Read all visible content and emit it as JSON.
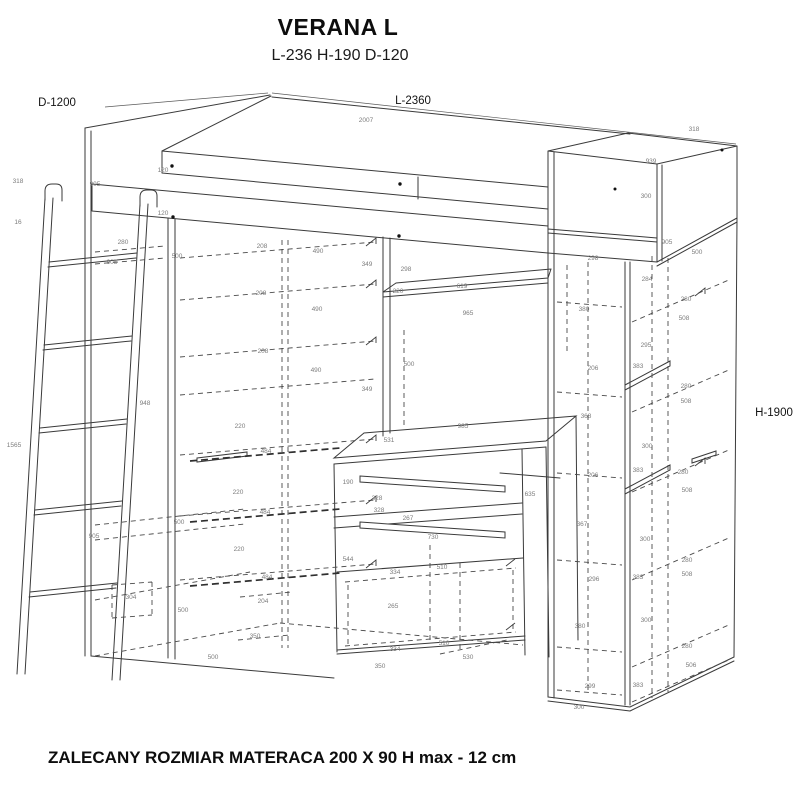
{
  "title": "VERANA L",
  "subtitle": "L-236 H-190 D-120",
  "footer": "ZALECANY ROZMIAR MATERACA 200 X 90 H max - 12 cm",
  "style_colors": {
    "line": "#3a3a3a",
    "dim_label": "#7d7d7d"
  },
  "main_dimensions": [
    {
      "text": "D-1200",
      "x": 57,
      "y": 106
    },
    {
      "text": "L-2360",
      "x": 413,
      "y": 104
    },
    {
      "text": "H-1900",
      "x": 774,
      "y": 416
    }
  ],
  "dimension_labels": [
    {
      "t": "2007",
      "x": 366,
      "y": 122
    },
    {
      "t": "318",
      "x": 694,
      "y": 131
    },
    {
      "t": "939",
      "x": 651,
      "y": 163
    },
    {
      "t": "300",
      "x": 646,
      "y": 198
    },
    {
      "t": "120",
      "x": 163,
      "y": 172
    },
    {
      "t": "120",
      "x": 163,
      "y": 215
    },
    {
      "t": "905",
      "x": 95,
      "y": 186
    },
    {
      "t": "318",
      "x": 18,
      "y": 183
    },
    {
      "t": "16",
      "x": 18,
      "y": 224
    },
    {
      "t": "905",
      "x": 667,
      "y": 244
    },
    {
      "t": "500",
      "x": 697,
      "y": 254
    },
    {
      "t": "298",
      "x": 593,
      "y": 260
    },
    {
      "t": "284",
      "x": 647,
      "y": 281
    },
    {
      "t": "380",
      "x": 584,
      "y": 311
    },
    {
      "t": "280",
      "x": 686,
      "y": 301
    },
    {
      "t": "508",
      "x": 684,
      "y": 320
    },
    {
      "t": "295",
      "x": 646,
      "y": 347
    },
    {
      "t": "280",
      "x": 123,
      "y": 244
    },
    {
      "t": "905",
      "x": 112,
      "y": 264
    },
    {
      "t": "500",
      "x": 177,
      "y": 258
    },
    {
      "t": "208",
      "x": 262,
      "y": 248
    },
    {
      "t": "490",
      "x": 318,
      "y": 253
    },
    {
      "t": "208",
      "x": 261,
      "y": 295
    },
    {
      "t": "490",
      "x": 317,
      "y": 311
    },
    {
      "t": "208",
      "x": 263,
      "y": 353
    },
    {
      "t": "490",
      "x": 316,
      "y": 372
    },
    {
      "t": "349",
      "x": 367,
      "y": 266
    },
    {
      "t": "298",
      "x": 406,
      "y": 271
    },
    {
      "t": "619",
      "x": 462,
      "y": 288
    },
    {
      "t": "220",
      "x": 398,
      "y": 293
    },
    {
      "t": "965",
      "x": 468,
      "y": 315
    },
    {
      "t": "500",
      "x": 409,
      "y": 366
    },
    {
      "t": "349",
      "x": 367,
      "y": 391
    },
    {
      "t": "948",
      "x": 145,
      "y": 405
    },
    {
      "t": "1565",
      "x": 14,
      "y": 447
    },
    {
      "t": "220",
      "x": 240,
      "y": 428
    },
    {
      "t": "484",
      "x": 266,
      "y": 453
    },
    {
      "t": "220",
      "x": 238,
      "y": 494
    },
    {
      "t": "484",
      "x": 265,
      "y": 514
    },
    {
      "t": "220",
      "x": 239,
      "y": 551
    },
    {
      "t": "484",
      "x": 267,
      "y": 579
    },
    {
      "t": "905",
      "x": 94,
      "y": 538
    },
    {
      "t": "500",
      "x": 179,
      "y": 524
    },
    {
      "t": "304",
      "x": 131,
      "y": 599
    },
    {
      "t": "500",
      "x": 183,
      "y": 612
    },
    {
      "t": "204",
      "x": 263,
      "y": 603
    },
    {
      "t": "350",
      "x": 255,
      "y": 638
    },
    {
      "t": "500",
      "x": 213,
      "y": 659
    },
    {
      "t": "985",
      "x": 463,
      "y": 428
    },
    {
      "t": "531",
      "x": 389,
      "y": 442
    },
    {
      "t": "190",
      "x": 348,
      "y": 484
    },
    {
      "t": "328",
      "x": 377,
      "y": 500
    },
    {
      "t": "328",
      "x": 379,
      "y": 512
    },
    {
      "t": "267",
      "x": 408,
      "y": 520
    },
    {
      "t": "730",
      "x": 433,
      "y": 539
    },
    {
      "t": "635",
      "x": 530,
      "y": 496
    },
    {
      "t": "544",
      "x": 348,
      "y": 561
    },
    {
      "t": "334",
      "x": 395,
      "y": 574
    },
    {
      "t": "510",
      "x": 442,
      "y": 569
    },
    {
      "t": "265",
      "x": 393,
      "y": 608
    },
    {
      "t": "334",
      "x": 395,
      "y": 651
    },
    {
      "t": "510",
      "x": 444,
      "y": 645
    },
    {
      "t": "530",
      "x": 468,
      "y": 659
    },
    {
      "t": "350",
      "x": 380,
      "y": 668
    },
    {
      "t": "206",
      "x": 593,
      "y": 370
    },
    {
      "t": "383",
      "x": 638,
      "y": 368
    },
    {
      "t": "280",
      "x": 686,
      "y": 388
    },
    {
      "t": "508",
      "x": 686,
      "y": 403
    },
    {
      "t": "368",
      "x": 586,
      "y": 418
    },
    {
      "t": "300",
      "x": 647,
      "y": 448
    },
    {
      "t": "206",
      "x": 593,
      "y": 477
    },
    {
      "t": "383",
      "x": 638,
      "y": 472
    },
    {
      "t": "280",
      "x": 683,
      "y": 474
    },
    {
      "t": "508",
      "x": 687,
      "y": 492
    },
    {
      "t": "367",
      "x": 582,
      "y": 526
    },
    {
      "t": "300",
      "x": 645,
      "y": 541
    },
    {
      "t": "296",
      "x": 594,
      "y": 581
    },
    {
      "t": "383",
      "x": 638,
      "y": 579
    },
    {
      "t": "280",
      "x": 687,
      "y": 562
    },
    {
      "t": "508",
      "x": 687,
      "y": 576
    },
    {
      "t": "380",
      "x": 580,
      "y": 628
    },
    {
      "t": "300",
      "x": 646,
      "y": 622
    },
    {
      "t": "280",
      "x": 687,
      "y": 648
    },
    {
      "t": "506",
      "x": 691,
      "y": 667
    },
    {
      "t": "299",
      "x": 590,
      "y": 688
    },
    {
      "t": "383",
      "x": 638,
      "y": 687
    },
    {
      "t": "300",
      "x": 579,
      "y": 709
    }
  ]
}
